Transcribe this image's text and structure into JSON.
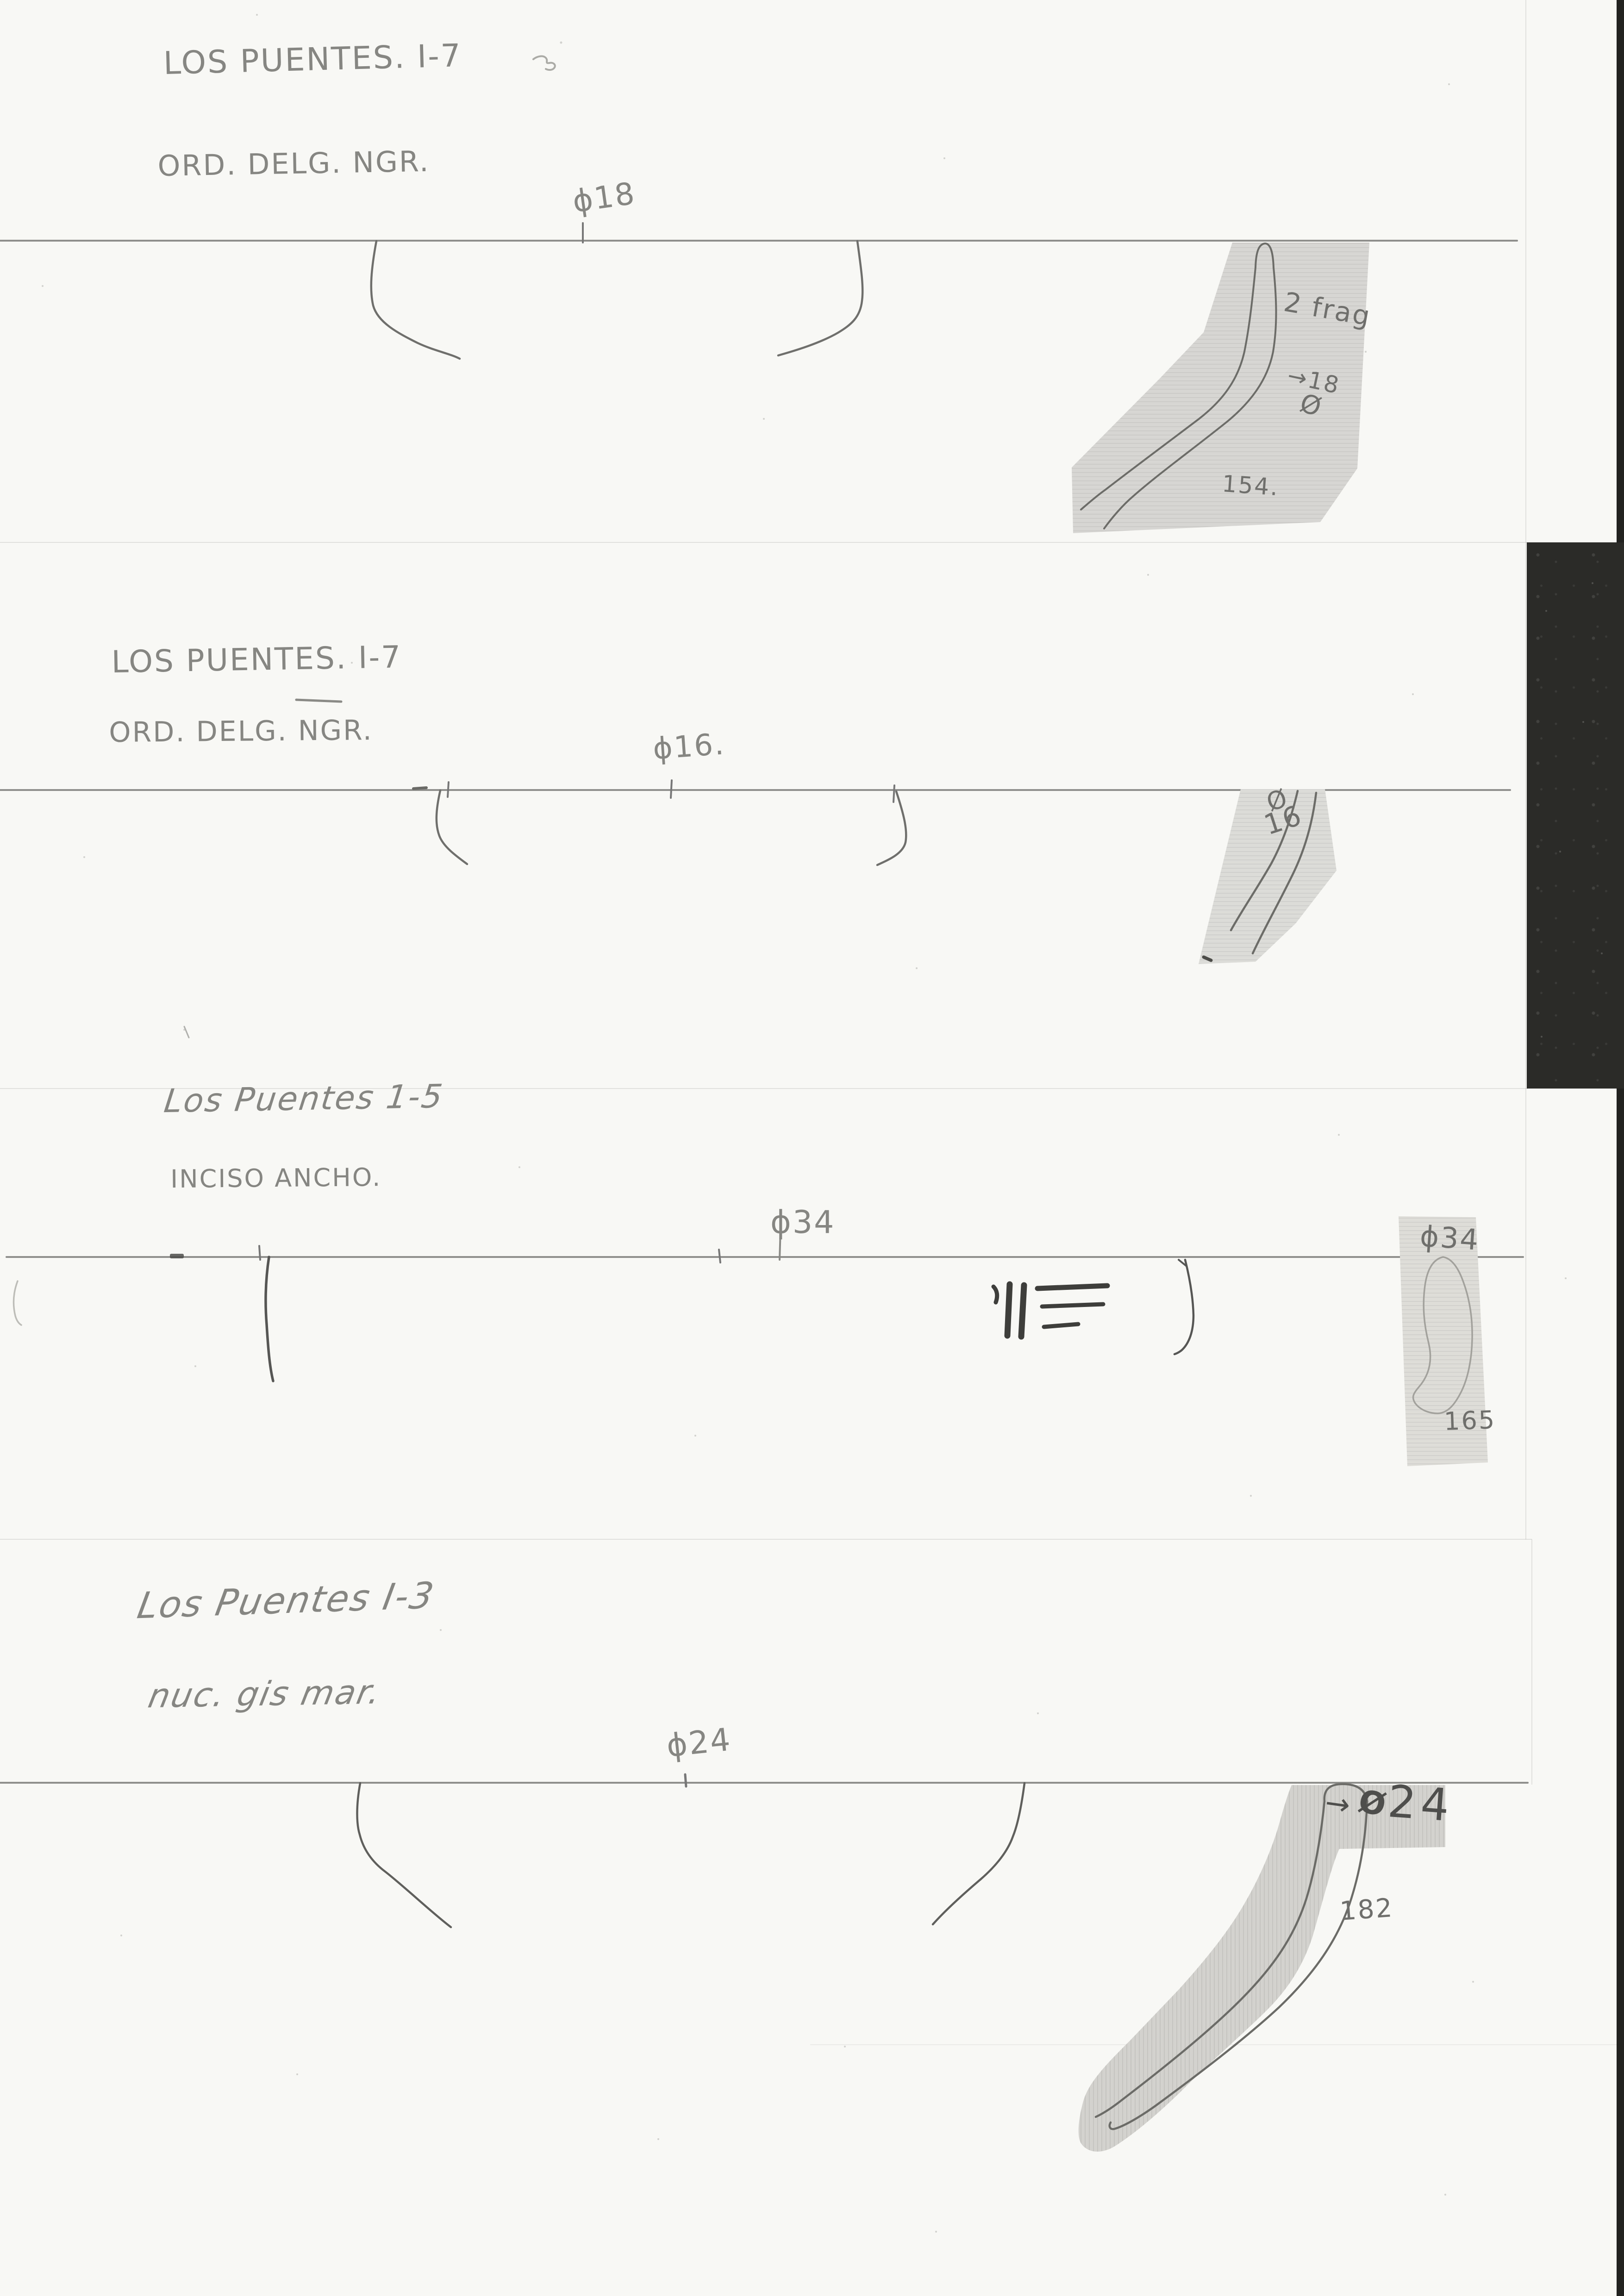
{
  "sections": [
    {
      "site_label": "LOS PUENTES. I-7",
      "ware_label": "ORD. DELG. NGR.",
      "rim_diameter_label": "ϕ18",
      "sherd_notes": {
        "fragment_count": "2 frag",
        "diameter_note": "→18",
        "diameter_symbol": "Ø",
        "inventory_number": "154."
      }
    },
    {
      "site_label": "LOS PUENTES. I-7",
      "ware_label": "ORD. DELG. NGR.",
      "rim_diameter_label": "ϕ16.",
      "sherd_notes": {
        "diameter_symbol": "Ø",
        "diameter_value": "16"
      }
    },
    {
      "site_label": "Los Puentes 1-5",
      "ware_label": "INCISO ANCHO.",
      "rim_diameter_label": "ϕ34",
      "sherd_notes": {
        "diameter_label": "ϕ34",
        "inventory_number": "165"
      }
    },
    {
      "site_label": "Los Puentes I-3",
      "ware_label": "nuc. gis mar.",
      "rim_diameter_label": "ϕ24",
      "sherd_notes": {
        "arrow": "→",
        "diameter_symbol": "Ø",
        "diameter_value": "24",
        "inventory_number": "182"
      }
    }
  ]
}
